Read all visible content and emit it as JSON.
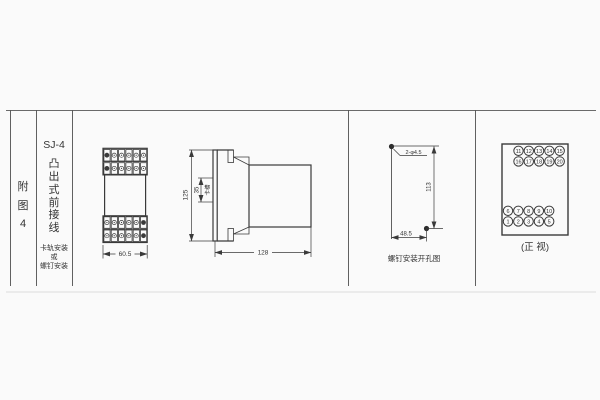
{
  "colors": {
    "line": "#3a3a3a",
    "background": "#fafafa",
    "frame_light": "#dcdcdc"
  },
  "left_panel": {
    "chars": [
      "附",
      "图",
      "4"
    ]
  },
  "title_panel": {
    "model": "SJ-4",
    "chars": [
      "凸",
      "出",
      "式",
      "前",
      "接",
      "线"
    ],
    "mount_lines": [
      "卡轨安装",
      "或",
      "螺钉安装"
    ]
  },
  "front_view": {
    "width_dim": "60.5",
    "cols": 6,
    "rows": 2
  },
  "side_view": {
    "height_dim": "125",
    "slot_dim": "35",
    "slot_label": "卡槽",
    "length_dim": "128"
  },
  "drill_view": {
    "holes_label": "2-φ4.5",
    "height_dim": "113",
    "width_dim": "48.5",
    "caption": "螺钉安装开孔图"
  },
  "terminal_view": {
    "top_rows": [
      [
        "11",
        "12",
        "13",
        "14",
        "15"
      ],
      [
        "16",
        "17",
        "18",
        "19",
        "20"
      ]
    ],
    "bottom_rows": [
      [
        "6",
        "7",
        "8",
        "9",
        "10"
      ],
      [
        "1",
        "2",
        "3",
        "4",
        "5"
      ]
    ],
    "caption": "(正 视)"
  }
}
